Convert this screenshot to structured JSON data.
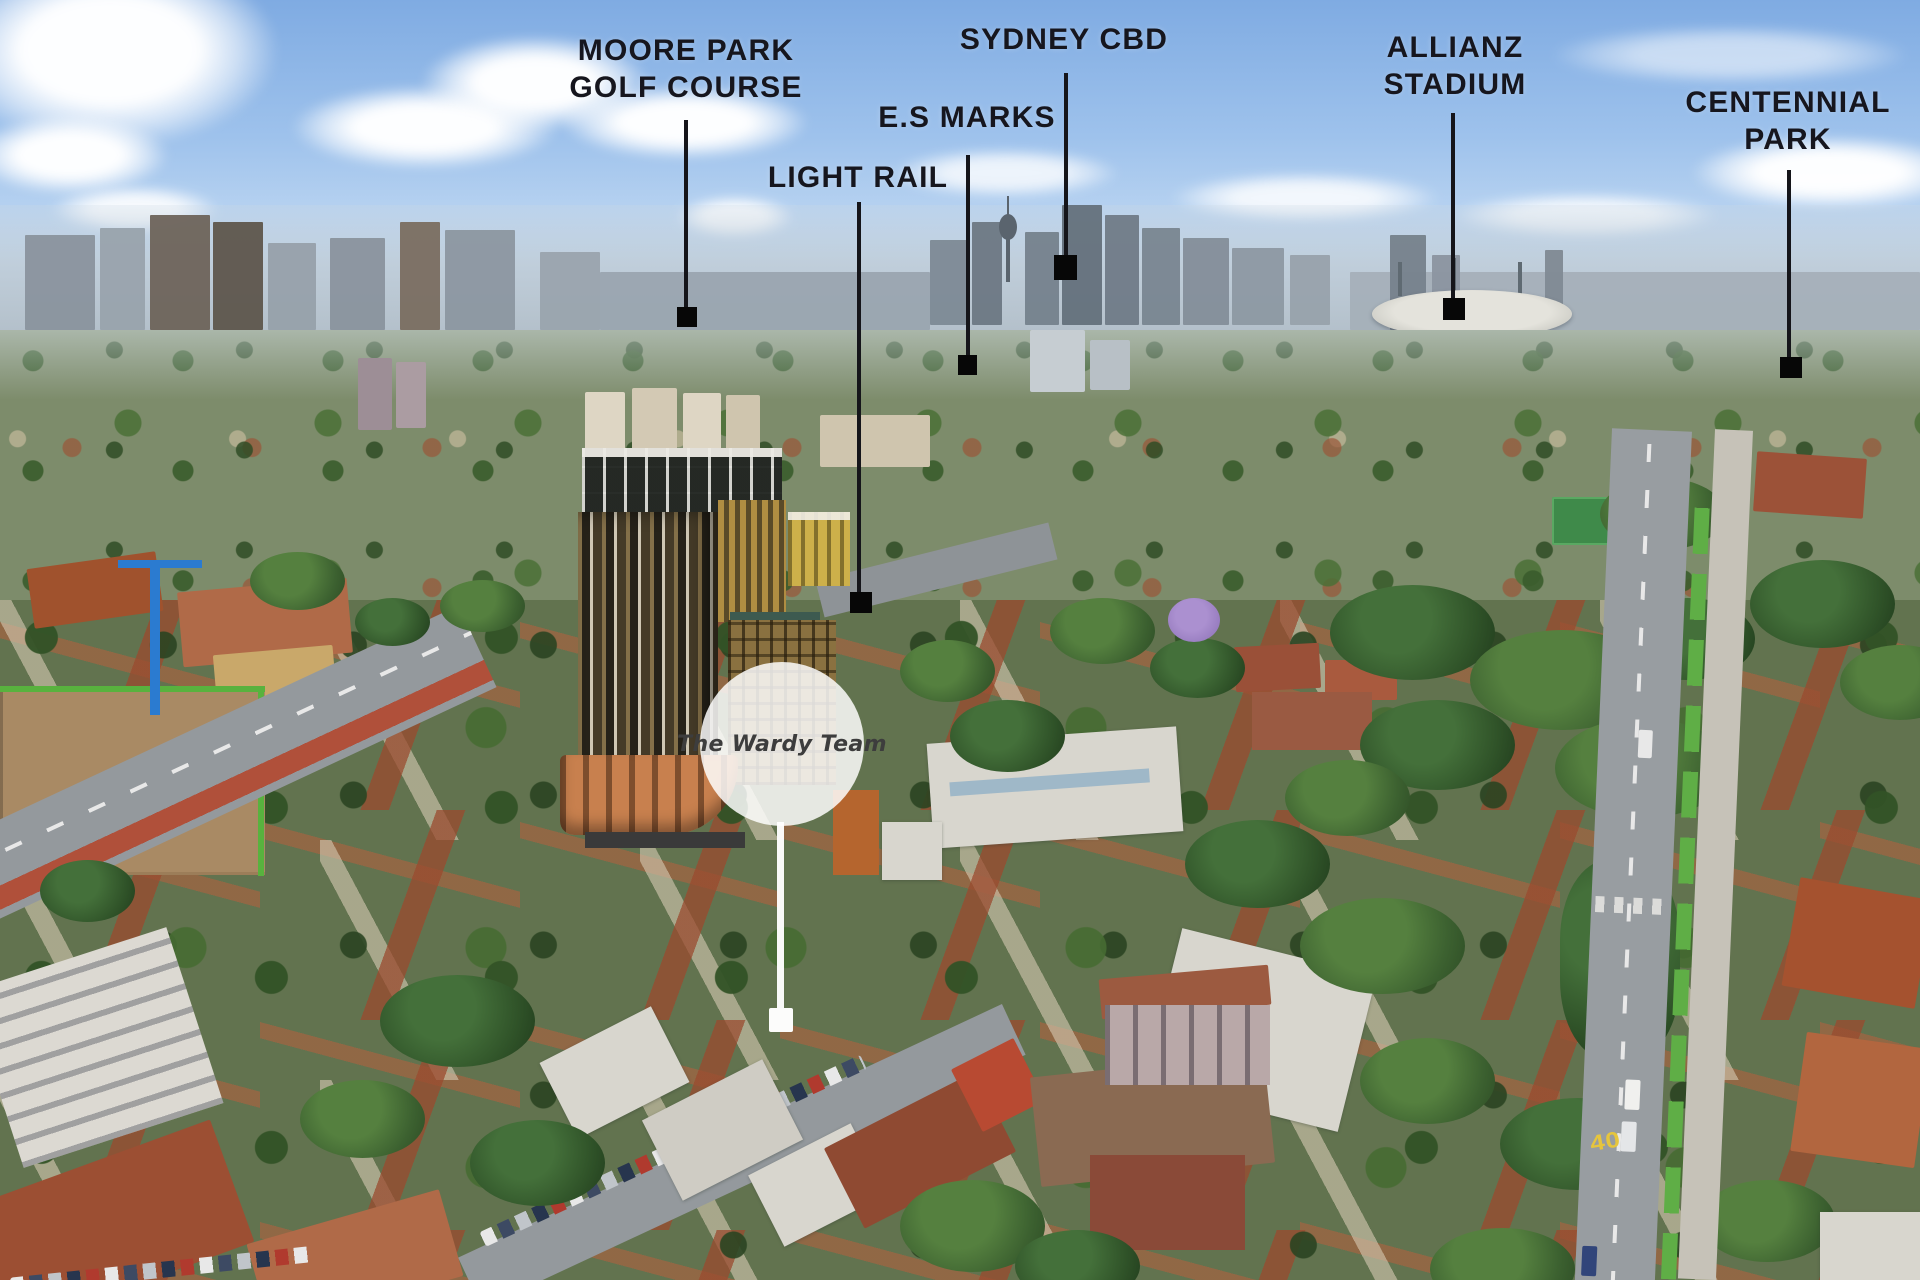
{
  "scene": {
    "description": "Aerial drone photograph of inner-Sydney suburbs looking toward the city skyline, with landmark callout labels",
    "road_marking": "40"
  },
  "annotations": {
    "labels": [
      {
        "id": "moore-park-golf-course",
        "text": "MOORE PARK\nGOLF COURSE"
      },
      {
        "id": "sydney-cbd",
        "text": "SYDNEY CBD"
      },
      {
        "id": "es-marks",
        "text": "E.S MARKS"
      },
      {
        "id": "light-rail",
        "text": "LIGHT RAIL"
      },
      {
        "id": "allianz-stadium",
        "text": "ALLIANZ\nSTADIUM"
      },
      {
        "id": "centennial-park",
        "text": "CENTENNIAL\nPARK"
      }
    ],
    "badge": {
      "text": "The Wardy Team"
    }
  },
  "colors": {
    "label_text": "#16161e",
    "annotation_line": "#15151a",
    "marker_square": "#070707",
    "badge_background": "rgba(255,255,255,0.84)",
    "badge_text": "#3d3d3d",
    "sky_top": "#7fabe2",
    "sky_horizon": "#dcebf7",
    "bike_lane_green": "#5fae46",
    "road_marking_yellow": "#e6c53c"
  }
}
